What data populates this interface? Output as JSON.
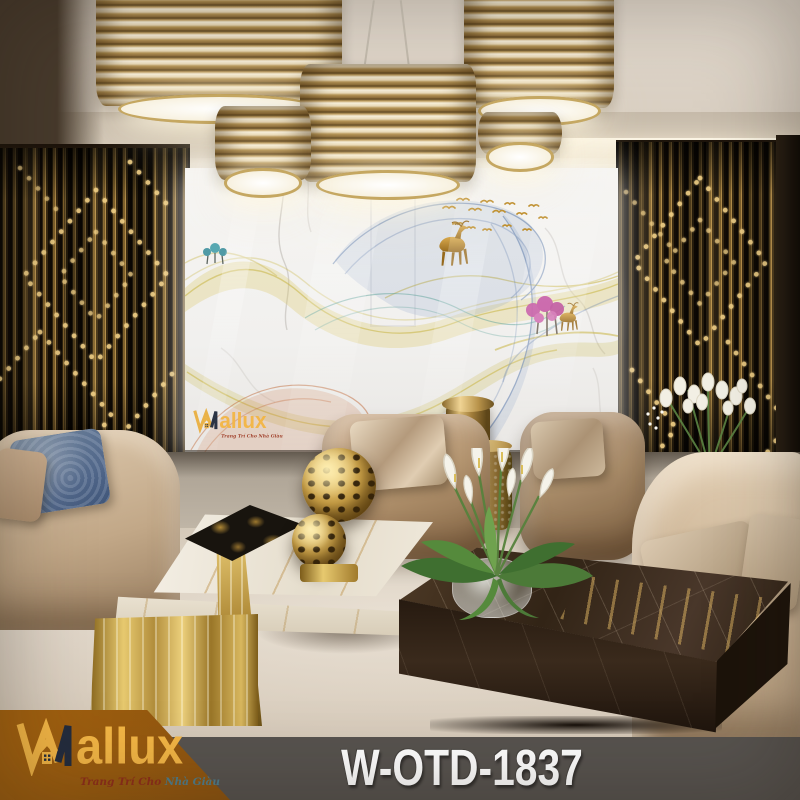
{
  "brand": {
    "name": "Wallux",
    "logo_suffix": "allux",
    "tagline": {
      "part1": "Trang Trí Cho",
      "part2": "Nhà Giàu"
    }
  },
  "watermark": {
    "logo_suffix": "allux",
    "tagline_full": "Trang Trí Cho Nhà Giàu"
  },
  "product": {
    "code": "W-OTD-1837"
  },
  "colors": {
    "banner_brown": "#9d5c10",
    "footer_gray": "#57534f",
    "logo_gold": "#f2b545",
    "logo_navy": "#232c3e",
    "tagline_red": "#8f2e1a",
    "tagline_teal": "#4f7e8d",
    "product_code_text": "#ffffff",
    "lamp_gold": "#c6a76a",
    "wall_rod_gold": "#8a6a33",
    "mural_background": "#f3f2ef",
    "ribbon_yellow": "#cdbb55",
    "ribbon_blue": "#5d7cab",
    "ribbon_teal": "#5fa39b",
    "ribbon_orange": "#c06a3a",
    "deer_gold": "#b9842c",
    "tree_pink": "#c2509f",
    "sofa_beige": "#c9b396",
    "emperador_brown": "#322416"
  }
}
